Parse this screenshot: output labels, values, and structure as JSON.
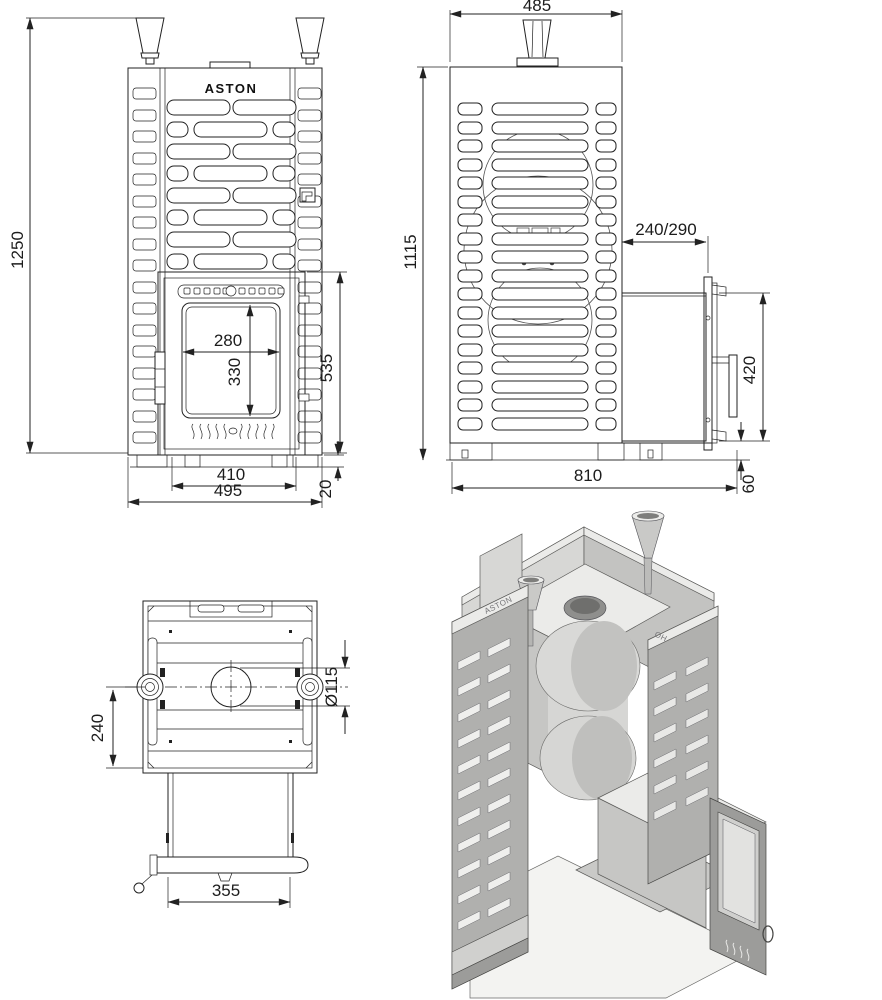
{
  "logo": "ASTON",
  "emboss": {
    "cage": "ASTON",
    "inner": "OH"
  },
  "dims": {
    "front": {
      "height": "1250",
      "glass_width": "280",
      "glass_height": "330",
      "door_height": "535",
      "base_width": "410",
      "overall_width": "495",
      "plinth_height": "20"
    },
    "side": {
      "depth": "485",
      "height": "1115",
      "tunnel_projection": "240/290",
      "tunnel_height": "420",
      "overall_depth": "810",
      "bottom_clearance": "60"
    },
    "top": {
      "valve_offset": "240",
      "chimney_diameter": "Ø115",
      "tunnel_width": "355"
    }
  }
}
